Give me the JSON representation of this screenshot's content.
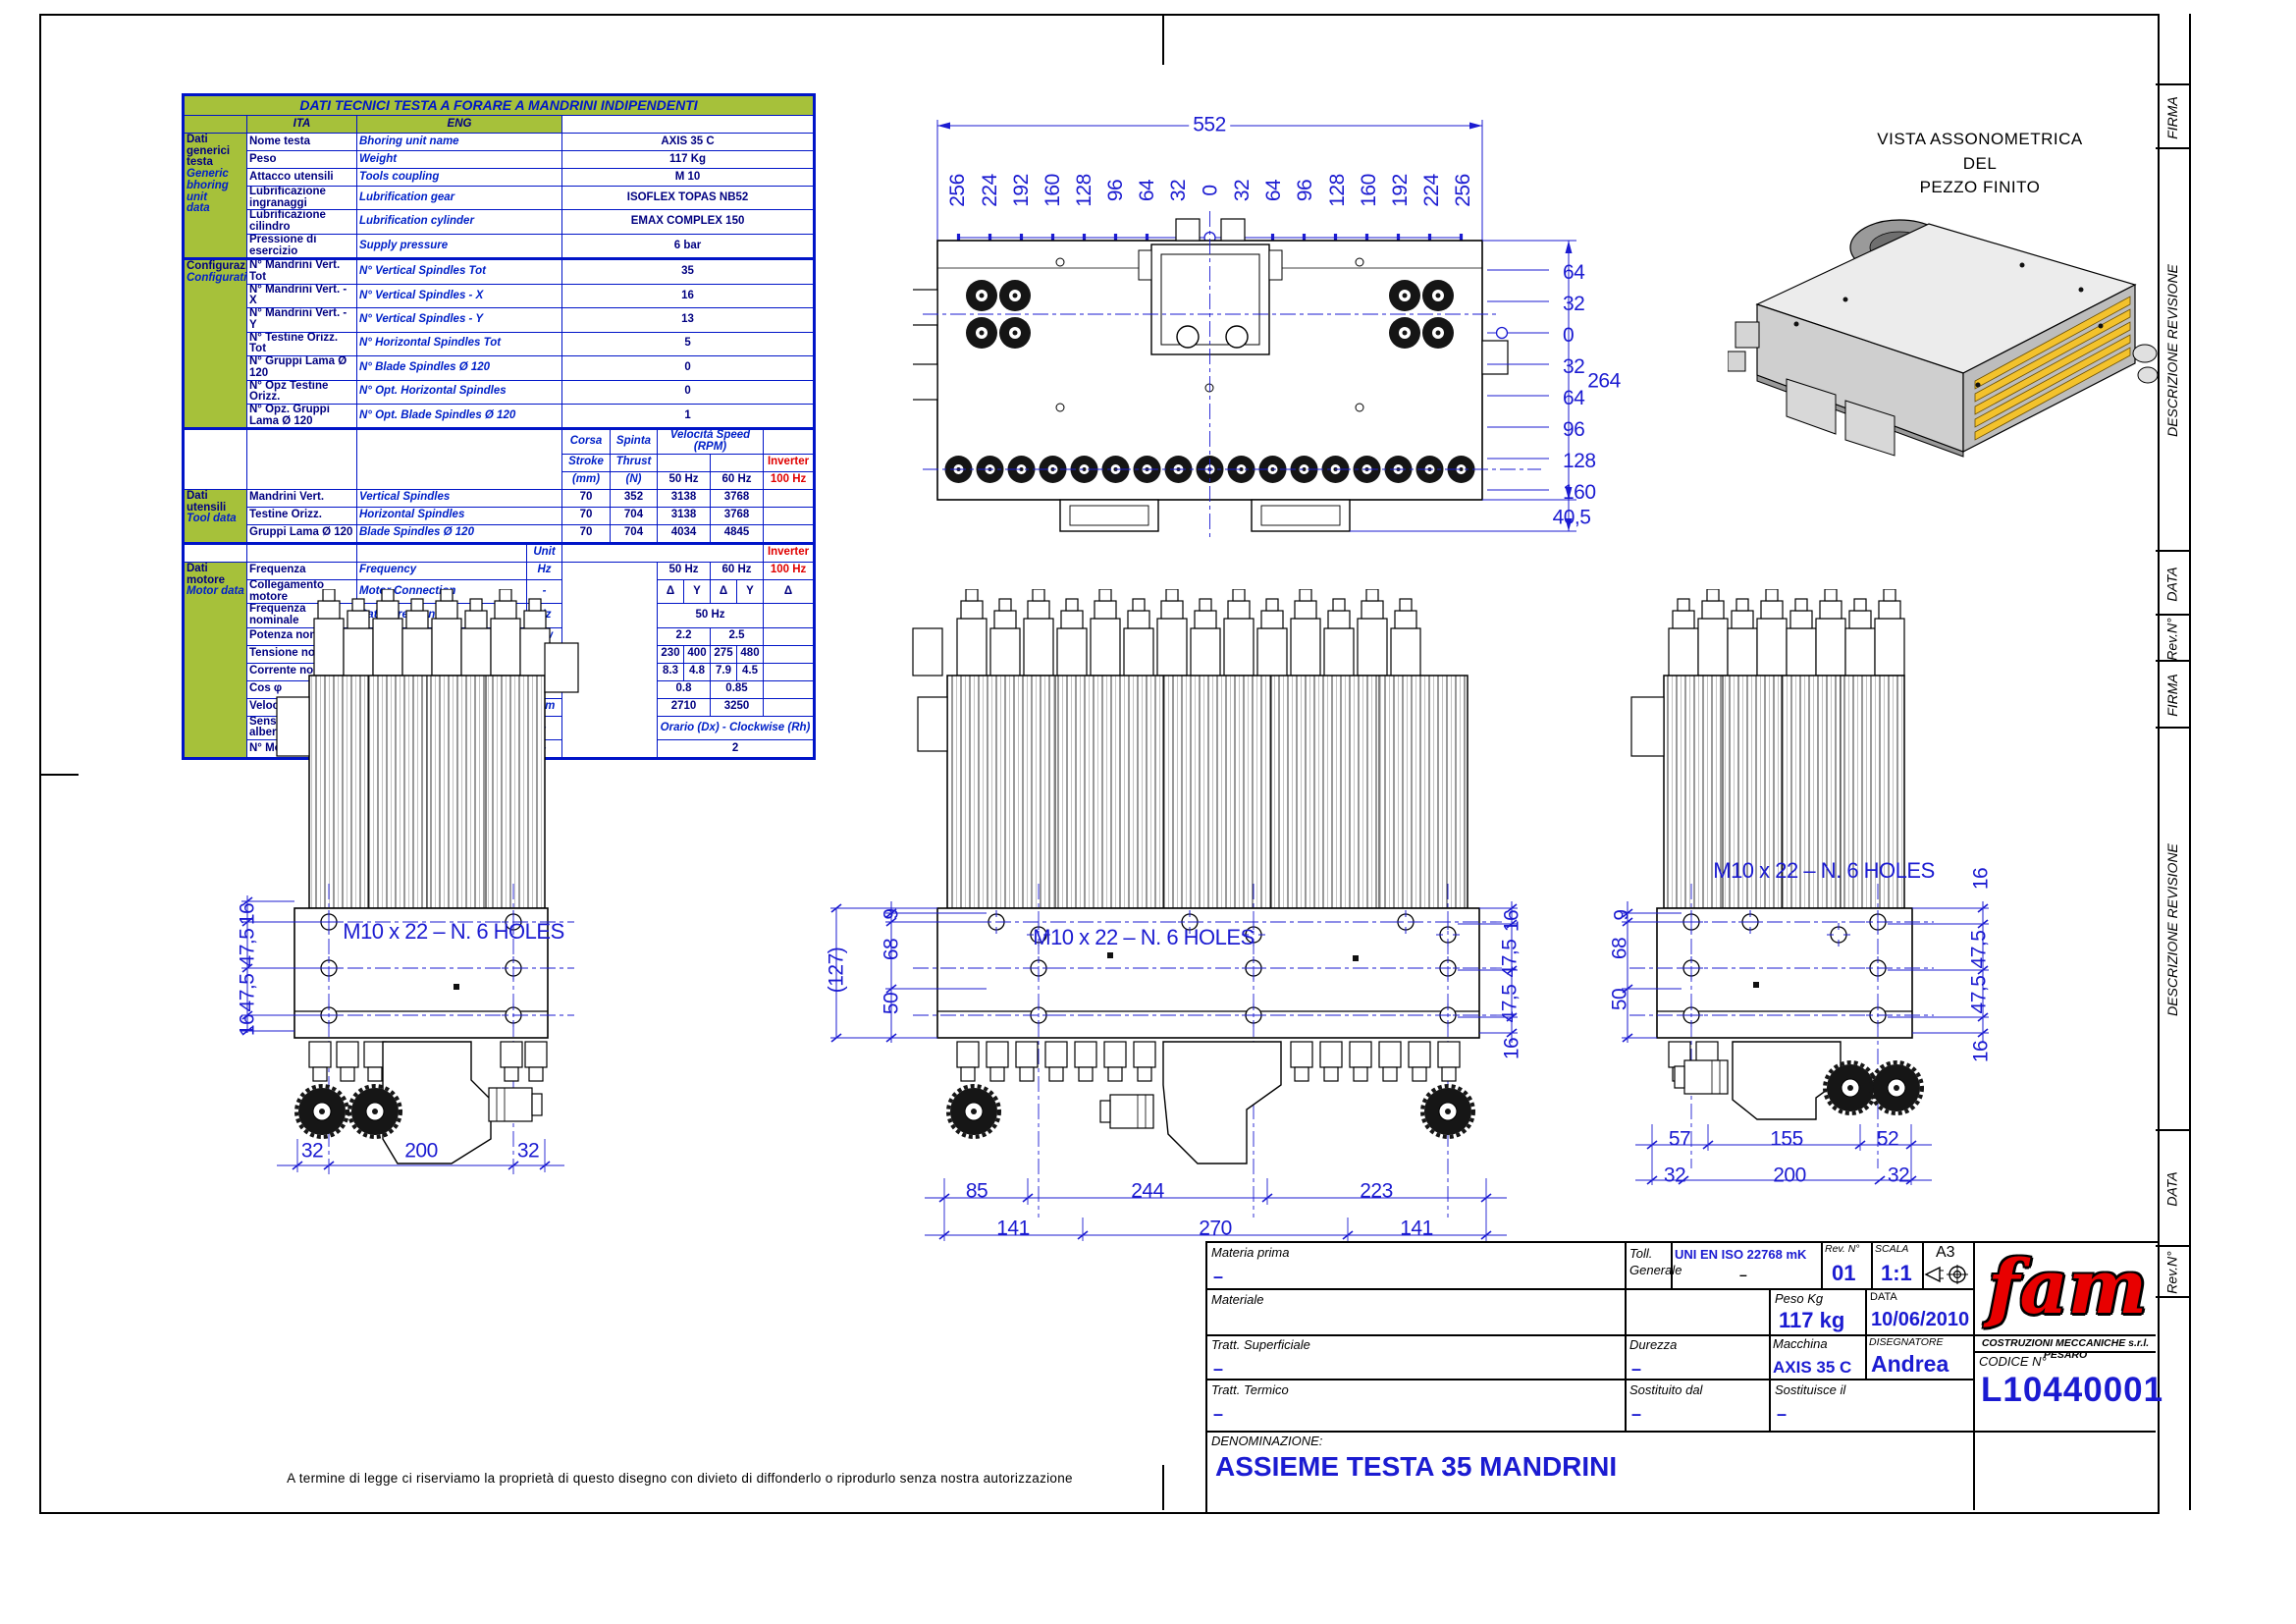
{
  "frame": {
    "firma": "FIRMA",
    "descrizione_revisione": "DESCRIZIONE REVISIONE",
    "data": "DATA",
    "rev_n": "Rev.N°",
    "disclaimer": "A termine di legge ci riserviamo la proprietà di questo disegno con divieto di diffonderlo o riprodurlo senza nostra autorizzazione"
  },
  "iso_view": {
    "title_line1": "VISTA ASSONOMETRICA",
    "title_line2": "DEL",
    "title_line3": "PEZZO FINITO"
  },
  "table": {
    "title": "DATI TECNICI TESTA A FORARE A MANDRINI INDIPENDENTI",
    "col_ita": "ITA",
    "col_eng": "ENG",
    "sections": {
      "generic": {
        "ita": "Dati generici\ntesta",
        "eng": "Generic\nbhoring unit\ndata"
      },
      "config": {
        "ita": "Configurazione",
        "eng": "Configuration"
      },
      "tool": {
        "ita": "Dati utensili",
        "eng": "Tool data"
      },
      "motor": {
        "ita": "Dati motore",
        "eng": "Motor data"
      }
    },
    "generic_rows": [
      {
        "ita": "Nome testa",
        "eng": "Bhoring unit name",
        "val": "AXIS 35 C"
      },
      {
        "ita": "Peso",
        "eng": "Weight",
        "val": "117 Kg"
      },
      {
        "ita": "Attacco utensili",
        "eng": "Tools coupling",
        "val": "M 10"
      },
      {
        "ita": "Lubrificazione ingranaggi",
        "eng": "Lubrification gear",
        "val": "ISOFLEX TOPAS NB52"
      },
      {
        "ita": "Lubrificazione cilindro",
        "eng": "Lubrification cylinder",
        "val": "EMAX COMPLEX 150"
      },
      {
        "ita": "Pressione di esercizio",
        "eng": "Supply pressure",
        "val": "6 bar"
      }
    ],
    "config_rows": [
      {
        "ita": "N° Mandrini Vert. Tot",
        "eng": "N° Vertical Spindles Tot",
        "val": "35"
      },
      {
        "ita": "N° Mandrini Vert. - X",
        "eng": "N° Vertical Spindles - X",
        "val": "16"
      },
      {
        "ita": "N° Mandrini Vert. - Y",
        "eng": "N° Vertical Spindles - Y",
        "val": "13"
      },
      {
        "ita": "N° Testine Orizz. Tot",
        "eng": "N° Horizontal Spindles Tot",
        "val": "5"
      },
      {
        "ita": "N° Gruppi Lama Ø 120",
        "eng": "N° Blade Spindles Ø 120",
        "val": "0"
      },
      {
        "ita": "N° Opz Testine Orizz.",
        "eng": "N° Opt. Horizontal Spindles",
        "val": "0"
      },
      {
        "ita": "N° Opz. Gruppi Lama Ø 120",
        "eng": "N° Opt. Blade Spindles Ø 120",
        "val": "1"
      }
    ],
    "tool_header": {
      "corsa": "Corsa",
      "stroke": "Stroke",
      "mm": "(mm)",
      "spinta": "Spinta",
      "thrust": "Thrust",
      "n": "(N)",
      "velocita": "Velocità Speed   (RPM)",
      "hz50": "50 Hz",
      "hz60": "60 Hz",
      "inverter": "Inverter",
      "hz100": "100 Hz"
    },
    "tool_rows": [
      {
        "ita": "Mandrini Vert.",
        "eng": "Vertical Spindles",
        "corsa": "70",
        "spinta": "352",
        "v50": "3138",
        "v60": "3768"
      },
      {
        "ita": "Testine Orizz.",
        "eng": "Horizontal Spindles",
        "corsa": "70",
        "spinta": "704",
        "v50": "3138",
        "v60": "3768"
      },
      {
        "ita": "Gruppi Lama Ø 120",
        "eng": "Blade Spindles Ø 120",
        "corsa": "70",
        "spinta": "704",
        "v50": "4034",
        "v60": "4845"
      }
    ],
    "unit_row": {
      "unit": "Unit",
      "inverter": "Inverter"
    },
    "motor_rows": {
      "freq": {
        "ita": "Frequenza",
        "eng": "Frequency",
        "unit": "Hz",
        "v50": "50 Hz",
        "v60": "60 Hz",
        "v100": "100 Hz"
      },
      "conn": {
        "ita": "Collegamento motore",
        "eng": "Motor Connection",
        "unit": "-",
        "d50": "Δ",
        "y50": "Y",
        "d60": "Δ",
        "y60": "Y",
        "d100": "Δ"
      },
      "rfreq": {
        "ita": "Frequenza nominale",
        "eng": "Rated frequency",
        "unit": "Hz",
        "val": "50 Hz"
      },
      "power": {
        "ita": "Potenza nominale",
        "eng": "Rated power",
        "unit": "Kw",
        "v50": "2.2",
        "v60": "2.5"
      },
      "volt": {
        "ita": "Tensione nominale",
        "eng": "Rated voltage",
        "unit": "V",
        "a50": "230",
        "b50": "400",
        "a60": "275",
        "b60": "480"
      },
      "curr": {
        "ita": "Corrente nominale",
        "eng": "Rated current",
        "unit": "A",
        "a50": "8.3",
        "b50": "4.8",
        "a60": "7.9",
        "b60": "4.5"
      },
      "cos": {
        "ita": "Cos φ",
        "eng": "Cos φ",
        "unit": "-",
        "v50": "0.8",
        "v60": "0.85"
      },
      "speed": {
        "ita": "Velocità",
        "eng": "Speed",
        "unit": "rpm",
        "v50": "2710",
        "v60": "3250"
      },
      "rot": {
        "ita": "Senso di rotazione albero",
        "eng": "Rotation shaft",
        "unit": "-",
        "val": "Orario (Dx) - Clockwise (Rh)"
      },
      "motors": {
        "ita": "N° Motori",
        "eng": "N° Motors",
        "unit": "-",
        "val": "2"
      }
    }
  },
  "top_view": {
    "width": "552",
    "ordinates": [
      "256",
      "224",
      "192",
      "160",
      "128",
      "96",
      "64",
      "32",
      "0",
      "32",
      "64",
      "96",
      "128",
      "160",
      "192",
      "224",
      "256"
    ],
    "right_ordinates": [
      "64",
      "32",
      "0",
      "32",
      "64",
      "96",
      "128",
      "160"
    ],
    "height": "264",
    "foot": "40,5"
  },
  "views": {
    "left": {
      "note": "M10   x  22 – N. 6 HOLES",
      "side_chain": [
        "16",
        "47,5",
        "47,5",
        "16"
      ],
      "bottom": [
        "32",
        "200",
        "32"
      ]
    },
    "center": {
      "note": "M10   x  22 – N. 6 HOLES",
      "overall": "(127)",
      "left_chain": [
        "9",
        "68",
        "50"
      ],
      "right_chain": [
        "16",
        "47,5",
        "47,5",
        "16"
      ],
      "bottom1": [
        "85",
        "244",
        "223"
      ],
      "bottom2": [
        "141",
        "270",
        "141"
      ]
    },
    "right": {
      "note": "M10   x  22 – N. 6 HOLES",
      "left_chain": [
        "9",
        "68",
        "50"
      ],
      "right_chain": [
        "16",
        "47,5",
        "47,5",
        "16"
      ],
      "bottom1": [
        "57",
        "155",
        "52"
      ],
      "bottom2": [
        "32",
        "200",
        "32"
      ]
    }
  },
  "title_block": {
    "materia_prima_label": "Materia prima",
    "materia_prima_val": "–",
    "toll_label1": "Toll.",
    "toll_label2": "Generale",
    "toll_val": "UNI EN ISO 22768 mK",
    "toll_val2": "–",
    "rev_label": "Rev. N°",
    "rev_val": "01",
    "scala_label": "SCALA",
    "scala_val": "1:1",
    "format": "A3",
    "materiale_label": "Materiale",
    "peso_label": "Peso Kg",
    "peso_val": "117 kg",
    "data_label": "DATA",
    "data_val": "10/06/2010",
    "tratt_sup_label": "Tratt. Superficiale",
    "tratt_sup_val": "–",
    "durezza_label": "Durezza",
    "durezza_val": "–",
    "macchina_label": "Macchina",
    "macchina_val": "AXIS 35 C",
    "disegnatore_label": "DISEGNATORE",
    "disegnatore_val": "Andrea",
    "company": "COSTRUZIONI MECCANICHE s.r.l. PESARO",
    "logo": "fam",
    "codice_label": "CODICE N°",
    "codice_val": "L10440001",
    "tratt_term_label": "Tratt. Termico",
    "tratt_term_val": "–",
    "sost_dal_label": "Sostituito dal",
    "sost_dal_val": "–",
    "sost_il_label": "Sostituisce il",
    "sost_il_val": "–",
    "denominazione_label": "DENOMINAZIONE:",
    "denominazione_val": "ASSIEME TESTA 35 MANDRINI"
  }
}
